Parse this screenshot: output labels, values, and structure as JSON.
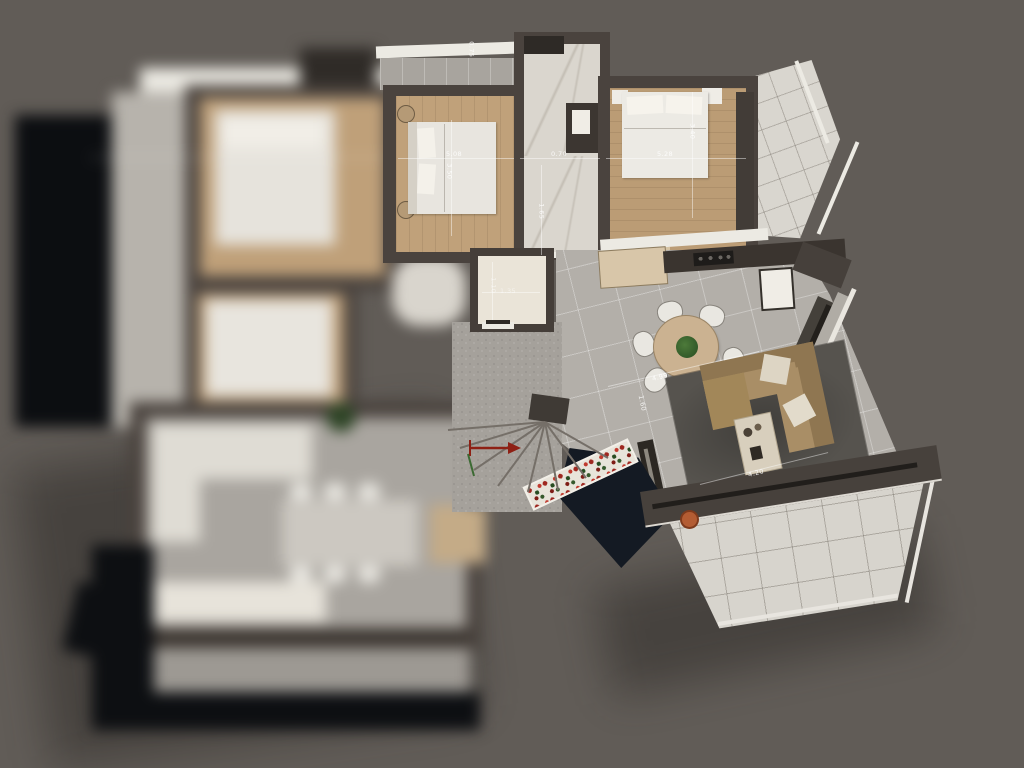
{
  "scene": {
    "description": "Top-down 3D architectural render of an apartment floor plan; left wing out of focus (depth-of-field blur), right unit in focus with bedrooms, bathroom, kitchen, dining, living room, winder stair and wrap-around terrace",
    "background_color": "#615c57"
  },
  "palette": {
    "wall": "#4a433e",
    "wood_floor": "#c0a17a",
    "interior_tile": "#b3afa9",
    "terrace_tile": "#d7d4cd",
    "rug": "#56534e",
    "sofa": "#a98e66",
    "flowers_red": "#a22c1e",
    "stair_void": "#141a23",
    "railing_white": "#eceae3"
  },
  "dimensions": {
    "top_balcony_depth": "0.75",
    "bedroom_a_width": "5.08",
    "bedroom_a_depth": "3.50",
    "hall_width": "0.70",
    "corridor_length": "1.65",
    "bedroom_b_width": "5.28",
    "bedroom_b_depth": "3.40",
    "living_width": "4.99",
    "stair_width": "1.60",
    "living_depth": "4.20",
    "wc_width": "1.35",
    "wc_depth": "1.10"
  }
}
